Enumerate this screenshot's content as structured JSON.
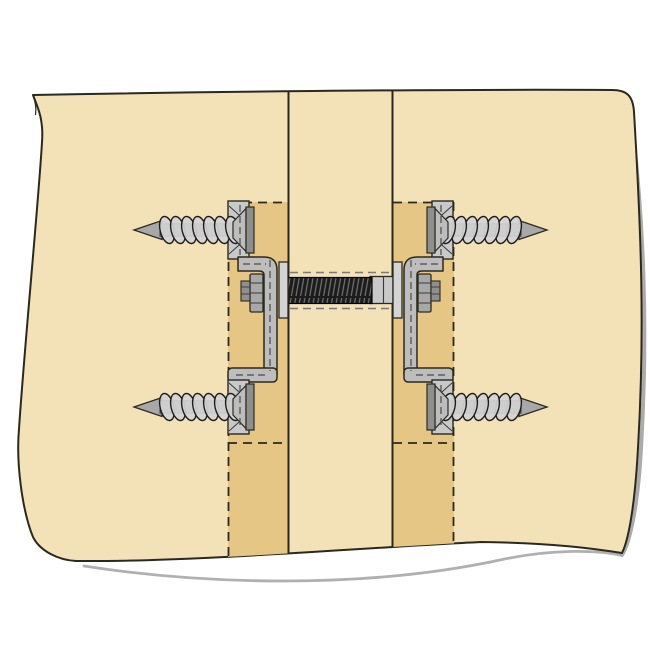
{
  "diagram": {
    "type": "technical-illustration",
    "description": "Cross-section diagram of two wood panels joined edge-to-edge by a spring-loaded panel connector: four countersunk lag screws on Z-brackets, hex nuts and washer plates compressing a coil spring on a threaded rod through the center stile",
    "visible_text": [],
    "colors": {
      "background": "#ffffff",
      "panel": "#F3E1B8",
      "groove": "#E6C685",
      "outline": "#2B291F",
      "metal_light": "#D4D4D4",
      "metal": "#BDBDBD",
      "metal_mid": "#A8A8A8",
      "metal_dark": "#8F8F8F",
      "plate": "#C9C9C9",
      "spring_dark": "#1C1C1C",
      "spring_sheen": "#757575",
      "hidden_line": "#4A4A4A",
      "rod_hidden": "#7A7A7A",
      "shadow": "#9C9C9C",
      "detail_line": "#3A3A3A"
    },
    "parts": {
      "panel": "wood-panel",
      "groove_left": "routed-groove-left",
      "groove_right": "routed-groove-right",
      "stile_left_edge": "center-stile-line-left",
      "stile_right_edge": "center-stile-line-right",
      "assembly_left": "connector-assembly-left",
      "assembly_right": "connector-assembly-right",
      "spring": "compression-spring",
      "sleeve": "spring-sleeve",
      "shadow_right": "edge-shadow-right",
      "shadow_bottom": "edge-shadow-bottom"
    }
  }
}
